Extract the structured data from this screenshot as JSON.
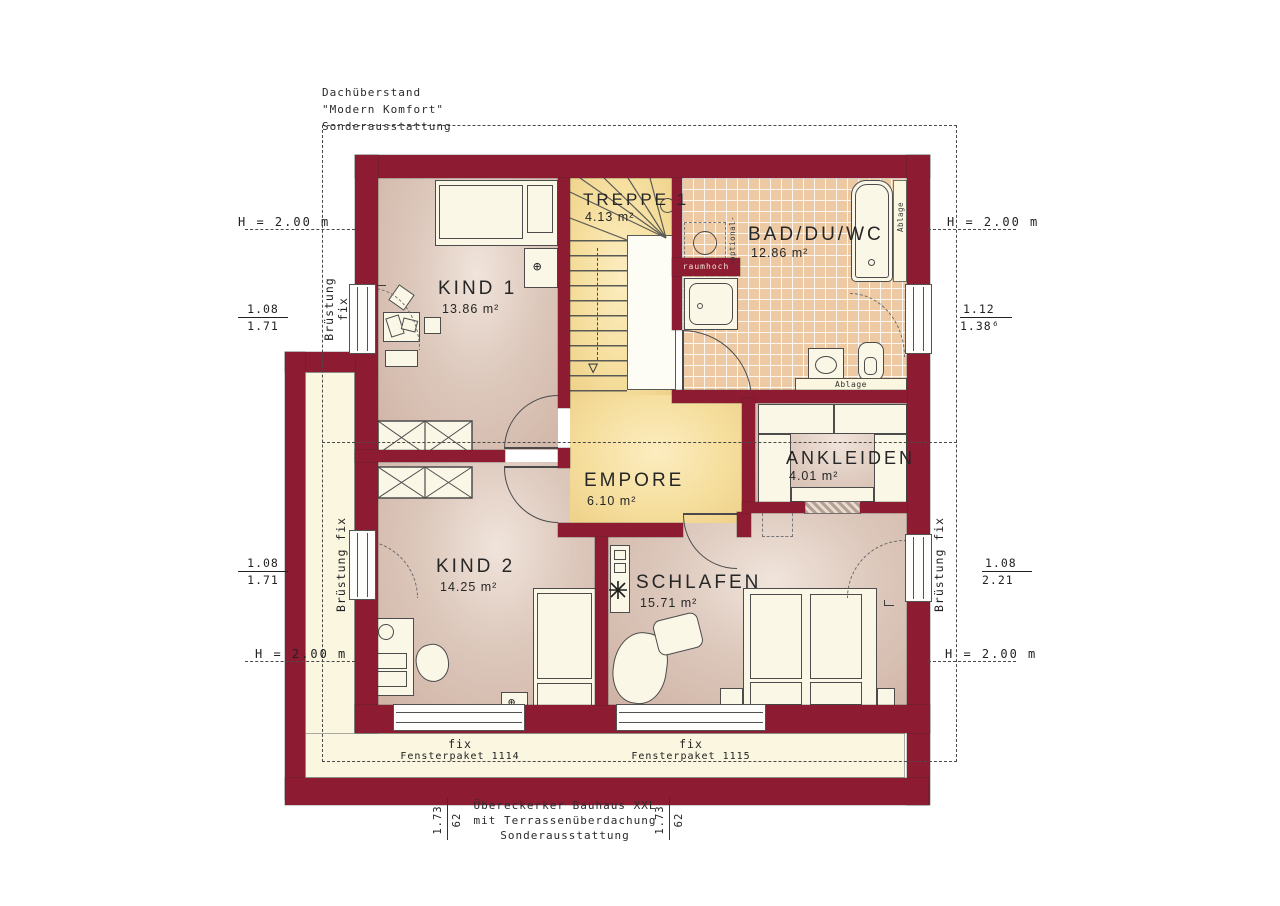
{
  "annotations": {
    "top_left": {
      "line1": "Dachüberstand",
      "line2": "\"Modern Komfort\"",
      "line3": "Sonderausstattung"
    },
    "bottom_center": {
      "line1": "Übereckerker Bauhaus XXL",
      "line2": "mit Terrassenüberdachung",
      "line3": "Sonderausstattung"
    }
  },
  "rooms": {
    "treppe": {
      "name": "TREPPE 1",
      "area": "4.13 m²"
    },
    "bad": {
      "name": "BAD/DU/WC",
      "area": "12.86 m²"
    },
    "kind1": {
      "name": "KIND 1",
      "area": "13.86 m²"
    },
    "empore": {
      "name": "EMPORE",
      "area": "6.10 m²"
    },
    "ankleiden": {
      "name": "ANKLEIDEN",
      "area": "4.01 m²"
    },
    "kind2": {
      "name": "KIND 2",
      "area": "14.25 m²"
    },
    "schlafen": {
      "name": "SCHLAFEN",
      "area": "15.71 m²"
    }
  },
  "dimensions": {
    "height_label": "H = 2.00 m",
    "left_top": {
      "num": "1.08",
      "den": "1.71"
    },
    "left_bottom": {
      "num": "1.08",
      "den": "1.71"
    },
    "right_top": {
      "num": "1.12",
      "den": "1.38⁶"
    },
    "right_bottom": {
      "num": "1.08",
      "den": "2.21"
    },
    "parapet_word": "Brüstung",
    "parapet_fix": "fix",
    "parapet_full": "Brüstung fix",
    "bottom_left_dim": {
      "a": "1.73",
      "b": "62"
    },
    "bottom_right_dim": {
      "a": "1.73",
      "b": "62"
    }
  },
  "windows": {
    "bottom1": {
      "type": "fix",
      "paket": "Fensterpaket 1114"
    },
    "bottom2": {
      "type": "fix",
      "paket": "Fensterpaket 1115"
    }
  },
  "bath": {
    "raumhoch": "raumhoch",
    "optional": "-optional-",
    "ablage_side": "Ablage",
    "ablage_bottom": "Ablage"
  },
  "colors": {
    "wall": "#8d1b31",
    "tile": "#edcaa3",
    "floor_warm": "#f4dc9e",
    "floor_pink": "#d9c0b2",
    "outside": "#faf6e0"
  }
}
